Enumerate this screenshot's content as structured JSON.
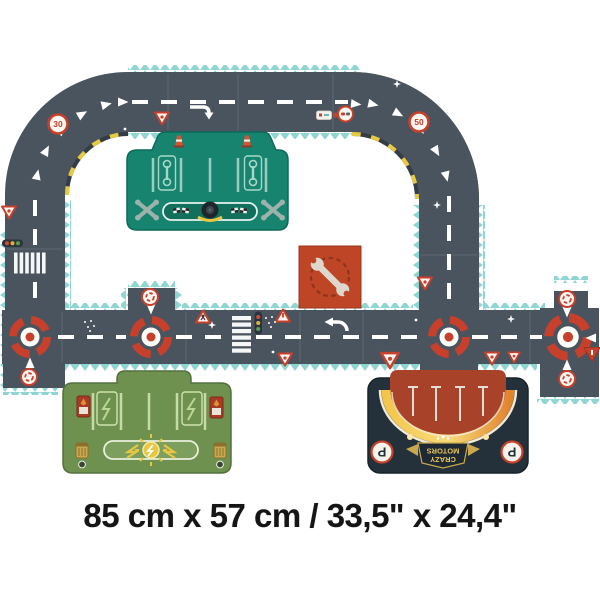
{
  "caption": "85 cm x 57 cm / 33,5\" x 24,4\"",
  "signs": {
    "speed_limit_left_curve": "30",
    "speed_limit_right_curve": "50"
  },
  "parking_garage": {
    "brand_line1": "CRAZY",
    "brand_line2": "MOTORS",
    "parking_letter": "P"
  },
  "colors": {
    "background": "#ffffff",
    "road": "#4a545f",
    "puzzle_edge_teal": "#8fd6d2",
    "hazard_yellow": "#e6cb42",
    "hazard_dark": "#343c45",
    "marking_white": "#ffffff",
    "sign_red": "#c6402c",
    "pit_stop_green": "#17846f",
    "charging_station_green": "#6e9150",
    "repair_square_red": "#bf4527",
    "parking_rust": "#a8432a",
    "parking_dark": "#24313a",
    "glow_yellow": "#f3c64b",
    "glow_orange": "#e2832e"
  }
}
